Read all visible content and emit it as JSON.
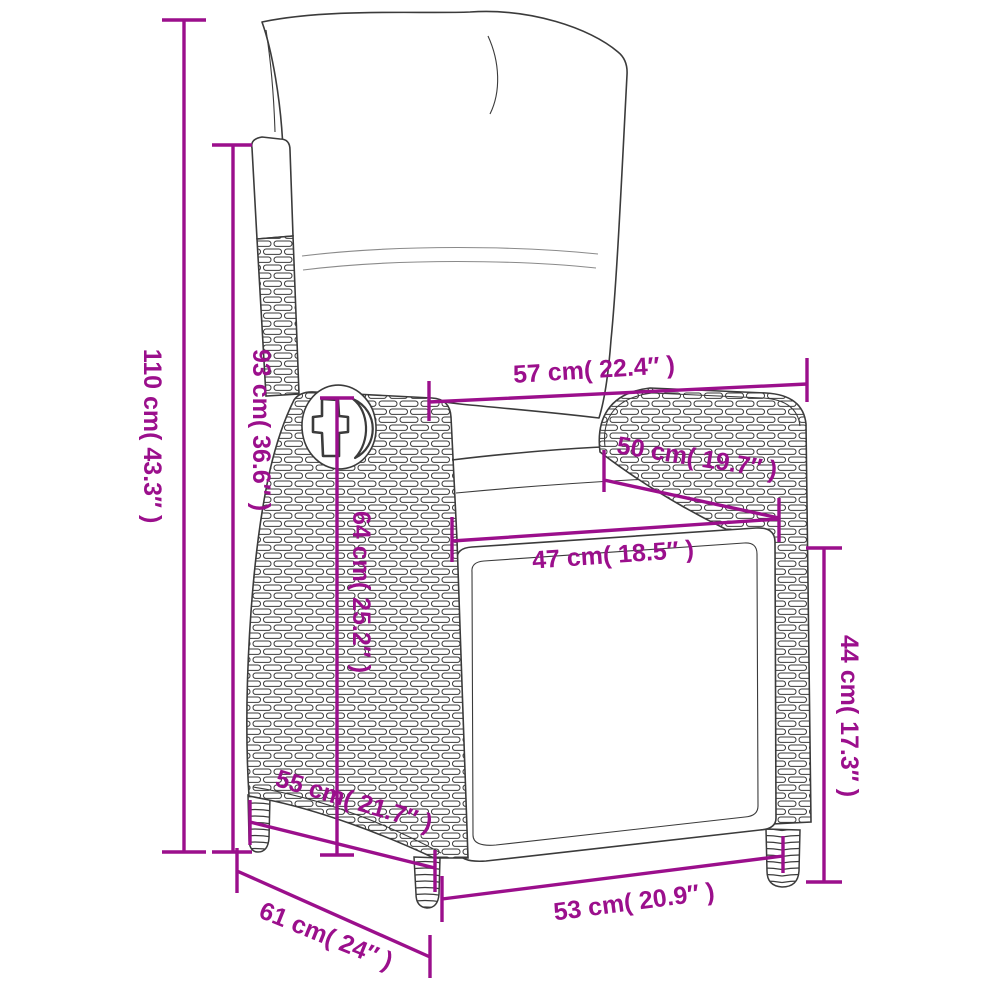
{
  "diagram": {
    "subject": "reclining garden chair with cushions",
    "style": "line-art dimension drawing",
    "accent_color": "#9b0f8c",
    "line_color": "#3b3b3b",
    "background_color": "#ffffff"
  },
  "measurements": [
    {
      "id": "overall-height",
      "cm": "110",
      "inches": "43.3",
      "text": "110 cm( 43.3″ )"
    },
    {
      "id": "backrest-height",
      "cm": "93",
      "inches": "36.6",
      "text": "93 cm( 36.6″ )"
    },
    {
      "id": "top-width",
      "cm": "57",
      "inches": "22.4",
      "text": "57 cm( 22.4″ )"
    },
    {
      "id": "armrest-length",
      "cm": "50",
      "inches": "19.7",
      "text": "50 cm( 19.7″ )"
    },
    {
      "id": "seat-width",
      "cm": "47",
      "inches": "18.5",
      "text": "47 cm( 18.5″ )"
    },
    {
      "id": "side-panel-height",
      "cm": "64",
      "inches": "25.2",
      "text": "64 cm( 25.2″ )"
    },
    {
      "id": "seat-height",
      "cm": "44",
      "inches": "17.3",
      "text": "44 cm( 17.3″ )"
    },
    {
      "id": "side-depth",
      "cm": "55",
      "inches": "21.7",
      "text": "55 cm( 21.7″ )"
    },
    {
      "id": "bottom-width",
      "cm": "53",
      "inches": "20.9",
      "text": "53 cm( 20.9″ )"
    },
    {
      "id": "overall-depth",
      "cm": "61",
      "inches": "24",
      "text": "61 cm( 24″ )"
    }
  ]
}
